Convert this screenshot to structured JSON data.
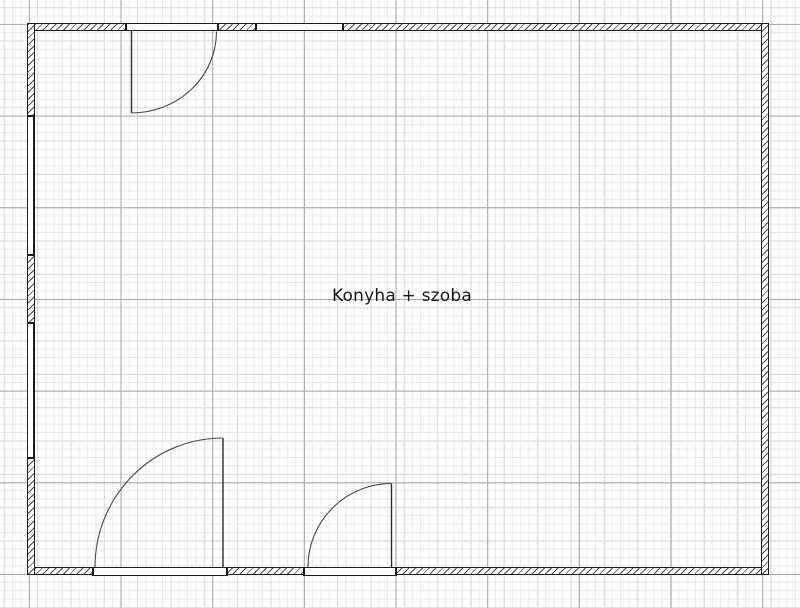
{
  "canvas": {
    "width": 800,
    "height": 608,
    "background": "#ffffff"
  },
  "grid": {
    "minor": {
      "spacing": 8.336,
      "color": "#e9e9ec",
      "offset_x": 3.79,
      "offset_y": 7.23
    },
    "medium": {
      "spacing": 33.344,
      "color": "#dcdce0",
      "offset_x": 3.79,
      "offset_y": 7.23
    },
    "major": {
      "spacing": 91.7,
      "color": "#a6a6ab",
      "offset_x": 28.8,
      "offset_y": 23.9
    }
  },
  "colors": {
    "wall_outline": "#1d1d1d",
    "hatch_line": "#4d4d4d",
    "door_leaf": "#2e2e2e",
    "door_arc": "#4a4a4a",
    "label_text": "#1a1a1a"
  },
  "room": {
    "label": "Konyha + szoba",
    "label_cx": 402,
    "label_cy": 296,
    "label_font_px": 17
  },
  "walls": [
    {
      "name": "wall-top",
      "x": 27,
      "y": 23,
      "w": 742,
      "h": 8
    },
    {
      "name": "wall-bottom",
      "x": 27,
      "y": 567,
      "w": 742,
      "h": 8
    },
    {
      "name": "wall-left",
      "x": 27,
      "y": 23,
      "w": 8,
      "h": 552
    },
    {
      "name": "wall-right",
      "x": 761,
      "y": 23,
      "w": 8,
      "h": 552
    }
  ],
  "openings": [
    {
      "name": "door-frame-top",
      "type": "door-frame",
      "x": 124.5,
      "y": 23,
      "w": 94,
      "h": 8,
      "caps": "vertical"
    },
    {
      "name": "window-top",
      "type": "window",
      "x": 255,
      "y": 23,
      "w": 89,
      "h": 8,
      "caps": "vertical"
    },
    {
      "name": "window-left-upper",
      "type": "window",
      "x": 27,
      "y": 115,
      "w": 6.5,
      "h": 141,
      "caps": "horizontal"
    },
    {
      "name": "window-left-lower",
      "type": "window",
      "x": 27,
      "y": 321.5,
      "w": 6.5,
      "h": 137,
      "caps": "horizontal"
    },
    {
      "name": "door-frame-bottom-left",
      "type": "door-frame",
      "x": 91.5,
      "y": 566.5,
      "w": 136.5,
      "h": 9,
      "caps": "vertical"
    },
    {
      "name": "door-frame-bottom-right",
      "type": "door-frame",
      "x": 303,
      "y": 566.5,
      "w": 94,
      "h": 9,
      "caps": "vertical"
    }
  ],
  "doors": [
    {
      "name": "door-swing-top",
      "leaf": "M131.5 31 L131.5 113",
      "arc": "M216.5 31.5 A85 81.5 0 0 1 131.5 113"
    },
    {
      "name": "door-swing-bottom-left",
      "leaf": "M223 567 L223 438",
      "arc": "M95 567 A128 129 0 0 1 223 438"
    },
    {
      "name": "door-swing-bottom-right",
      "leaf": "M391.5 567 L391.5 483.5",
      "arc": "M308 567 A83.5 83.5 0 0 1 391.5 483.5"
    }
  ]
}
